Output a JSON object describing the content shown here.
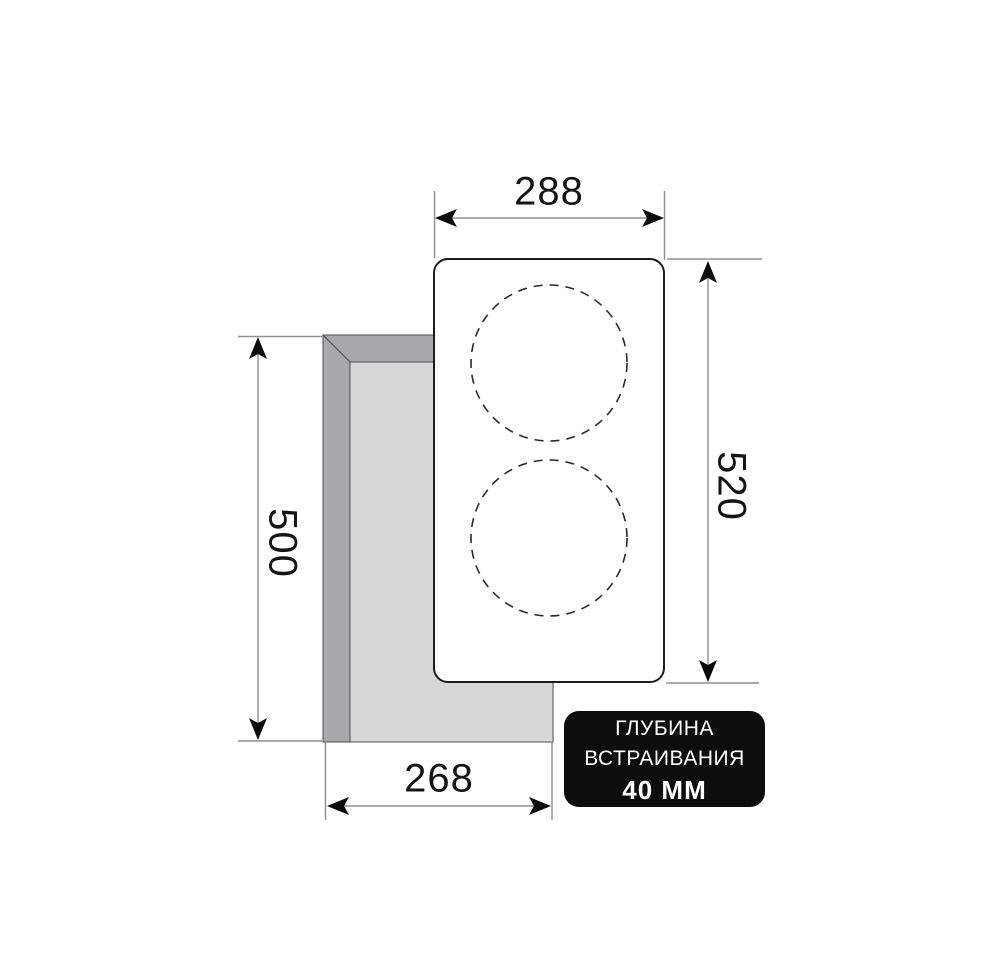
{
  "diagram": {
    "width_top_mm": "288",
    "height_right_mm": "520",
    "cutout_height_left_mm": "500",
    "cutout_width_bottom_mm": "268"
  },
  "badge": {
    "line1": "ГЛУБИНА",
    "line2": "ВСТРАИВАНИЯ",
    "line3": "40 ММ"
  },
  "colors": {
    "background": "#ffffff",
    "panel_fill": "#ffffff",
    "panel_outline": "#1c1c1c",
    "zone_dash": "#2b2b2b",
    "cutout_edge": "#a9a9ab",
    "cutout_face": "#d7d7d8",
    "cutout_line": "#4f4f4f",
    "dimension_line": "#8f8f8f",
    "arrow": "#0b0b0b",
    "badge_bg": "#0d0d0d",
    "badge_text": "#ffffff"
  }
}
